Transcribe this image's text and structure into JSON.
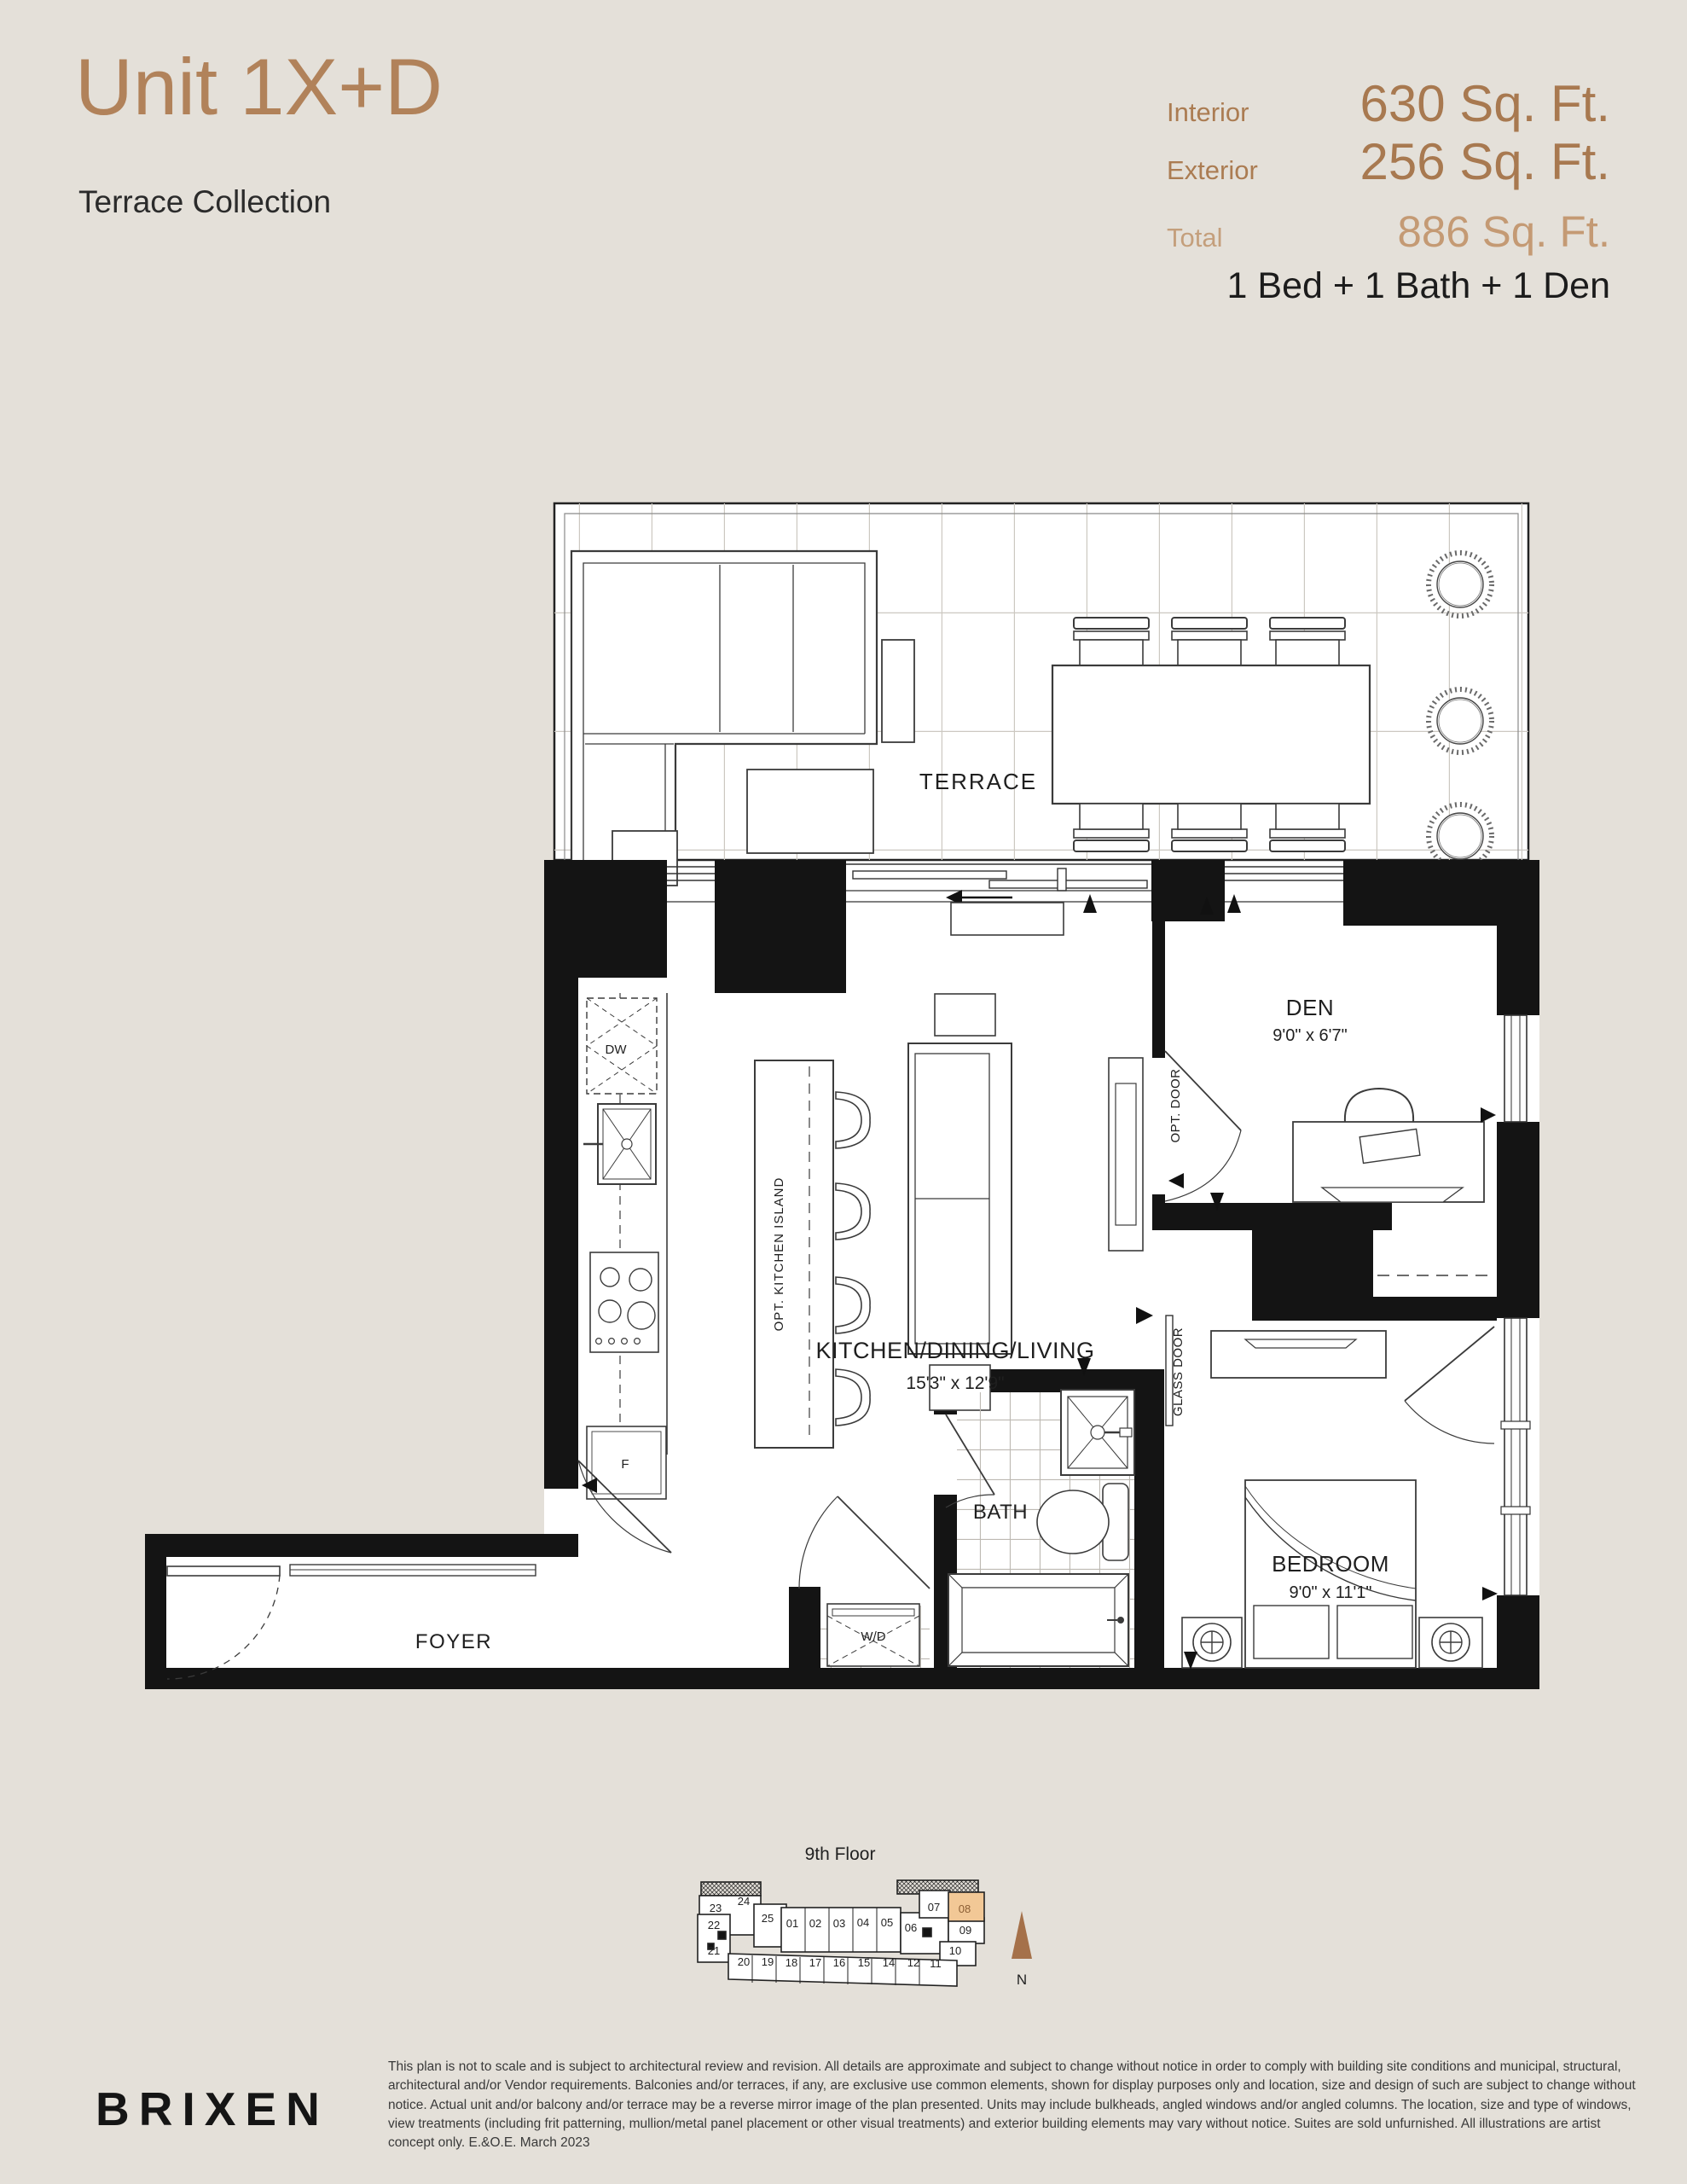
{
  "header": {
    "unit_title": "Unit 1X+D",
    "collection": "Terrace Collection",
    "stats": [
      {
        "label": "Interior",
        "value": "630 Sq. Ft."
      },
      {
        "label": "Exterior",
        "value": "256 Sq. Ft."
      },
      {
        "label": "Total",
        "value": "886 Sq. Ft."
      }
    ],
    "configuration": "1 Bed + 1 Bath + 1 Den"
  },
  "colors": {
    "accent_brown": "#b1825a",
    "light_brown": "#c49a74",
    "page_background": "#e4e0d9",
    "plan_ink": "#141414",
    "keyplan_highlight": "#f2c896",
    "compass_brown": "#a5714a"
  },
  "floorplan": {
    "rooms": [
      {
        "id": "terrace",
        "name": "TERRACE",
        "dims": ""
      },
      {
        "id": "kitchen",
        "name": "KITCHEN/DINING/LIVING",
        "dims": "15'3\" x 12'9\""
      },
      {
        "id": "den",
        "name": "DEN",
        "dims": "9'0\" x 6'7\""
      },
      {
        "id": "bedroom",
        "name": "BEDROOM",
        "dims": "9'0\" x 11'1\""
      },
      {
        "id": "bath",
        "name": "BATH",
        "dims": ""
      },
      {
        "id": "foyer",
        "name": "FOYER",
        "dims": ""
      }
    ],
    "fixtures": [
      {
        "id": "dw",
        "label": "DW"
      },
      {
        "id": "f",
        "label": "F"
      },
      {
        "id": "wd",
        "label": "W/D"
      }
    ],
    "annotations": [
      {
        "id": "island",
        "label": "OPT. KITCHEN ISLAND"
      },
      {
        "id": "optdoor",
        "label": "OPT. DOOR"
      },
      {
        "id": "glassdoor",
        "label": "GLASS DOOR"
      }
    ]
  },
  "keyplan": {
    "title": "9th Floor",
    "compass": "N",
    "highlighted_unit": "08",
    "units": [
      "23",
      "24",
      "25",
      "01",
      "02",
      "03",
      "04",
      "05",
      "06",
      "07",
      "08",
      "09",
      "10",
      "11",
      "12",
      "14",
      "15",
      "16",
      "17",
      "18",
      "19",
      "20",
      "21",
      "22"
    ]
  },
  "footer": {
    "logo": "BRIXEN",
    "disclaimer": "This plan is not to scale and is subject to architectural review and revision. All details are approximate and subject to change without notice in order to comply with building site conditions and municipal, structural, architectural and/or Vendor requirements. Balconies and/or terraces, if any, are exclusive use common elements, shown for display purposes only and location, size and design of such are subject to change without notice. Actual unit and/or balcony and/or terrace may be a reverse mirror image of the plan presented. Units may include bulkheads, angled windows and/or angled columns. The location, size and type of windows, view treatments (including frit patterning, mullion/metal panel placement or other visual treatments) and exterior building elements may vary without notice. Suites are sold unfurnished. All illustrations are artist concept only. E.&O.E. March 2023"
  }
}
